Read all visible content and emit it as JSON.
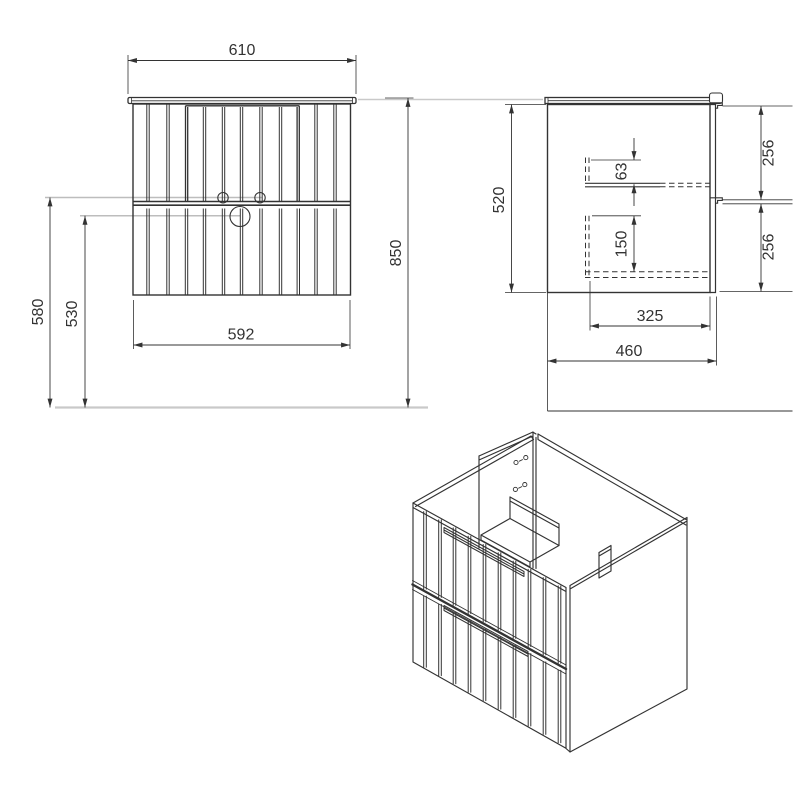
{
  "drawing": {
    "type": "furniture technical drawing (vanity cabinet with two drawers)",
    "colors": {
      "line": "#333333",
      "construction": "#c9c9c9",
      "text": "#333333",
      "background": "#ffffff"
    },
    "views": {
      "front": {
        "name": "front view",
        "dims": {
          "w_top": "610",
          "w_bottom": "592",
          "h_total": "850",
          "h_divider": "580",
          "h_drain": "530"
        }
      },
      "side": {
        "name": "side view",
        "dims": {
          "h_body": "520",
          "gap_top": "63",
          "gap_bottom": "150",
          "front_top": "256",
          "front_bottom": "256",
          "d_inner": "325",
          "d_total": "460"
        }
      },
      "iso": {
        "name": "isometric view"
      }
    }
  }
}
